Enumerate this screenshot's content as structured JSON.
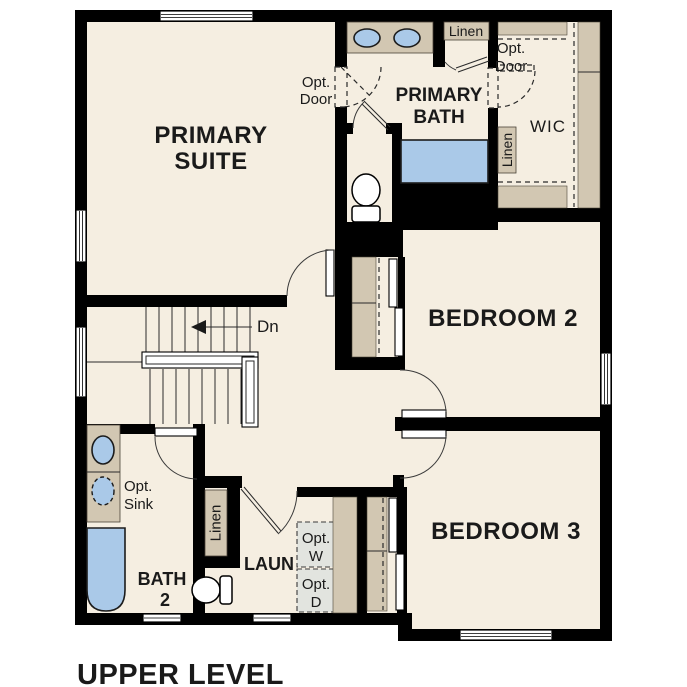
{
  "colors": {
    "page_bg": "#ffffff",
    "floor": "#f5eee1",
    "wall": "#000000",
    "cabinet_tan": "#d2c7b2",
    "fixture_blue": "#aac9e8",
    "appliance_gray": "#e2e4df",
    "text": "#1a1a1a"
  },
  "plan": {
    "level_title": "UPPER LEVEL",
    "rooms": {
      "primary_suite": {
        "lines": [
          "PRIMARY",
          "SUITE"
        ]
      },
      "primary_bath": {
        "lines": [
          "PRIMARY",
          "BATH"
        ]
      },
      "wic": {
        "label": "WIC"
      },
      "bedroom2": {
        "label": "BEDROOM 2"
      },
      "bedroom3": {
        "label": "BEDROOM 3"
      },
      "bath2": {
        "lines": [
          "BATH",
          "2"
        ]
      },
      "laundry": {
        "label": "LAUN"
      }
    },
    "annotations": {
      "linen_top": {
        "label": "Linen"
      },
      "linen_wic": {
        "label": "Linen"
      },
      "linen_hall": {
        "label": "Linen"
      },
      "opt_door_bath": {
        "lines": [
          "Opt.",
          "Door"
        ]
      },
      "opt_door_wic": {
        "lines": [
          "Opt.",
          "Door"
        ]
      },
      "opt_sink": {
        "lines": [
          "Opt.",
          "Sink"
        ]
      },
      "opt_washer": {
        "lines": [
          "Opt.",
          "W"
        ]
      },
      "opt_dryer": {
        "lines": [
          "Opt.",
          "D"
        ]
      },
      "stairs": {
        "label": "Dn"
      }
    }
  }
}
